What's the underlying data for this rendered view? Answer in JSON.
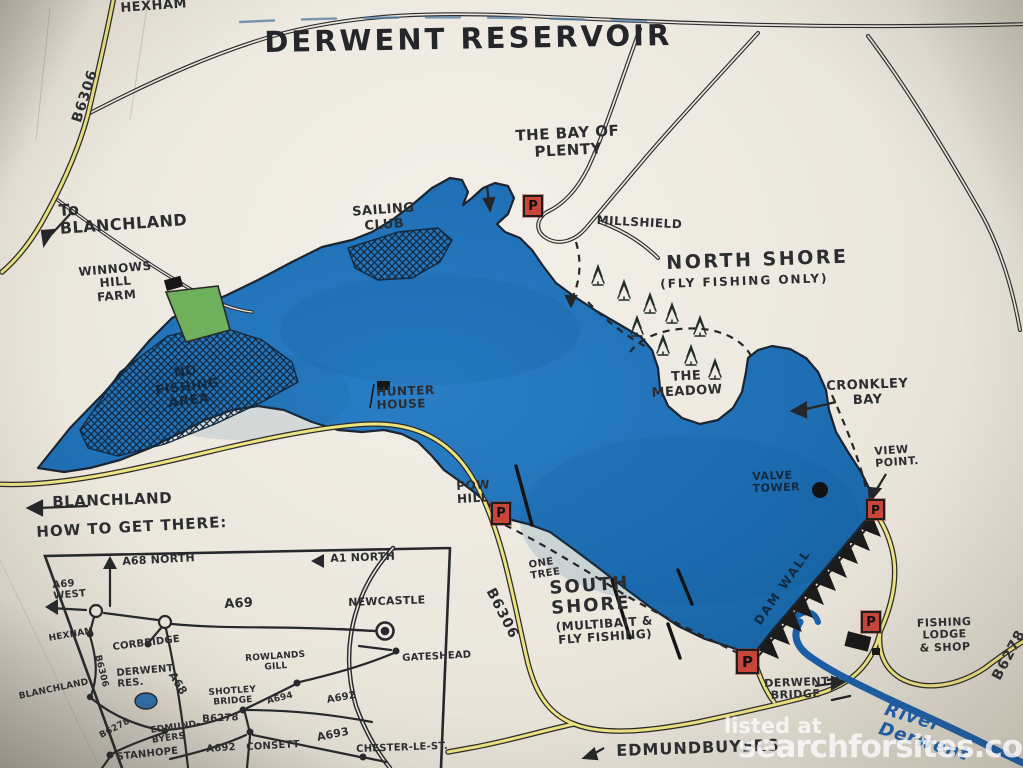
{
  "title": "DERWENT RESERVOIR",
  "watermark": {
    "line1": "listed at",
    "line2": "searchforsites.co.uk"
  },
  "icons": {
    "parking_letter": "P"
  },
  "colors": {
    "water": "#1f6fb5",
    "road_yellow": "#ece481",
    "ink": "#2b2d30",
    "parking_red": "#c8453a",
    "farm_green": "#6fb05c",
    "river_blue": "#1a5ea8",
    "paper": "#ebe7dd"
  },
  "map": {
    "labels": {
      "hexham_top": "HEXHAM",
      "b6306_nw": "B6306",
      "bay_of_plenty": "THE BAY OF\nPLENTY",
      "to_blanchland": "To\nBLANCHLAND",
      "sailing_club": "SAILING\nCLUB",
      "millshield": "MILLSHIELD",
      "north_shore": "NORTH SHORE",
      "north_shore_sub": "(FLY FISHING ONLY)",
      "winnows_hill_farm": "WINNOWS\nHILL\nFARM",
      "no_fishing_area": "NO\nFISHING\nAREA",
      "hunter_house": "HUNTER\nHOUSE",
      "the_meadow": "THE\nMEADOW",
      "cronkley_bay": "CRONKLEY\nBAY",
      "view_point": "VIEW\nPOINT.",
      "valve_tower": "VALVE\nTOWER",
      "blanchland_west": "BLANCHLAND",
      "pow_hill": "POW\nHILL",
      "one_tree": "ONE\nTREE",
      "b6306_south": "B6306",
      "south_shore": "SOUTH\nSHORE",
      "south_shore_sub": "(MULTIBAIT &\nFLY FISHING)",
      "dam_wall": "DAM WALL",
      "fishing_lodge": "FISHING\nLODGE\n& SHOP",
      "b6278_east": "B6278",
      "derwent_bridge": "DERWENT\nBRIDGE",
      "edmundbuyers": "EDMUNDBUYERS",
      "river_derwent": "River Derwent"
    }
  },
  "inset": {
    "title": "HOW TO GET THERE:",
    "labels": {
      "a69_west": "A69\nWEST",
      "a68_north": "A68 NORTH",
      "a1_north": "A1 NORTH",
      "a69": "A69",
      "newcastle": "NEWCASTLE",
      "hexham": "HEXHAM",
      "corbridge": "CORBRIDGE",
      "b6306": "B6306",
      "gateshead": "GATESHEAD",
      "derwent_res": "DERWENT\nRES.",
      "a68": "A68",
      "rowlands_gill": "ROWLANDS\nGILL",
      "shotley_bridge": "SHOTLEY\nBRIDGE",
      "a694": "A694",
      "a692_east": "A692",
      "blanchland": "BLANCHLAND",
      "b6278_sw": "B6278",
      "edmundbyers": "EDMUND-\nBYERS",
      "b6278_mid": "B6278",
      "a692_south": "A692",
      "consett": "CONSETT",
      "a693": "A693",
      "chester_le_st": "CHESTER-LE-ST.",
      "stanhope": "STANHOPE"
    }
  }
}
